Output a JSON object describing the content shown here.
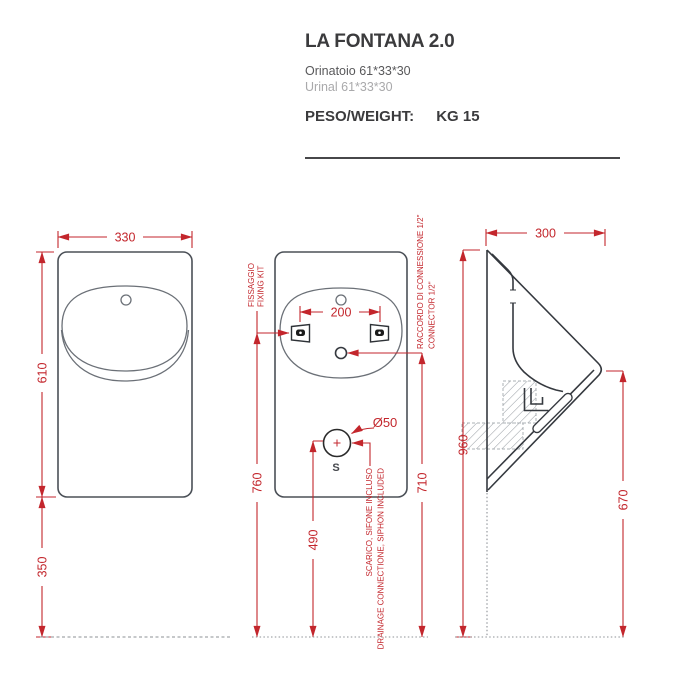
{
  "header": {
    "title": "LA FONTANA 2.0",
    "subtitle_it": "Orinatoio 61*33*30",
    "subtitle_en": "Urinal 61*33*30",
    "weight_label": "PESO/WEIGHT:",
    "weight_value": "KG 15"
  },
  "colors": {
    "dimension_red": "#c3262c",
    "outline_gray": "#4b5057",
    "hatch_gray": "#9aa0a5"
  },
  "views": {
    "front": {
      "width_mm": "330",
      "height_mm": "610",
      "floor_clearance_mm": "350"
    },
    "rear": {
      "fixing_spacing_mm": "200",
      "fixing_height_mm": "760",
      "drain_height_mm": "490",
      "connector_height_mm": "710",
      "drain_diameter": "Ø50",
      "drain_symbol": "S",
      "fixing_label_line1": "FISSAGGIO",
      "fixing_label_line2": "FIXING KIT",
      "connector_label_line1": "RACCORDO DI CONNESSIONE 1/2\"",
      "connector_label_line2": "CONNECTOR 1/2\"",
      "drain_label_line1": "SCARICO, SIFONE INCLUSO",
      "drain_label_line2": "DRAINAGE CONNECTIONE, SIPHON INCLUDED"
    },
    "side": {
      "depth_mm": "300",
      "height_mm": "960",
      "lip_height_mm": "670"
    }
  }
}
